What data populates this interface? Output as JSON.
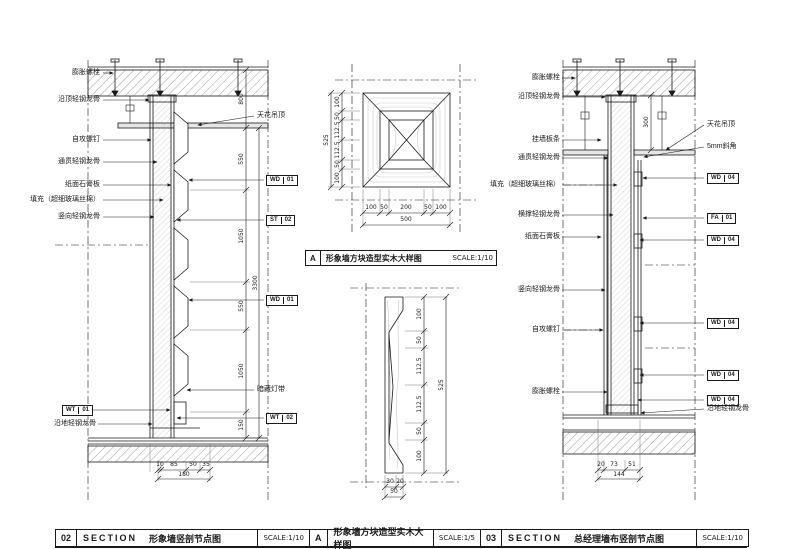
{
  "left_panel": {
    "labels_left": [
      "膨胀螺栓",
      "沿顶轻钢龙骨",
      "自攻螺钉",
      "通贯轻钢龙骨",
      "纸面石膏板",
      "填充（超细玻璃丝棉）",
      "竖向轻钢龙骨"
    ],
    "bottom_tag": {
      "c": "WT",
      "n": "01"
    },
    "bottom_label": "沿地轻钢龙骨",
    "label_ceiling": "天花吊顶",
    "label_light": "暗藏灯带",
    "tags_right": [
      {
        "c": "WD",
        "n": "01"
      },
      {
        "c": "ST",
        "n": "02"
      },
      {
        "c": "WD",
        "n": "01"
      },
      {
        "c": "WT",
        "n": "02"
      }
    ],
    "dim_top": "800",
    "dims_chain": [
      "550",
      "1050",
      "550",
      "1050",
      "150"
    ],
    "dim_total": "3300",
    "dims_bottom": [
      "10",
      "85",
      "50",
      "35"
    ],
    "dim_bottom_total": "180"
  },
  "middle_panel": {
    "label": {
      "key": "A",
      "title": "形象墙方块造型实木大样图",
      "scale": "SCALE:1/10"
    },
    "square": {
      "dims_left": [
        "100",
        "50",
        "112.5",
        "112.5",
        "50",
        "100"
      ],
      "dim_left_total": "525",
      "dims_bottom": [
        "100",
        "50",
        "200",
        "50",
        "100"
      ],
      "dim_bottom_total": "500"
    },
    "profile": {
      "dims_right": [
        "100",
        "50",
        "112.5",
        "112.5",
        "50",
        "100"
      ],
      "dim_right_total": "525",
      "dims_bottom": [
        "30",
        "20"
      ],
      "dim_bottom_total": "50"
    }
  },
  "right_panel": {
    "labels_left": [
      "膨胀螺栓",
      "沿顶轻钢龙骨",
      "挂墙板条",
      "通贯轻钢龙骨",
      "填充（超细玻璃丝棉）",
      "横撑轻钢龙骨",
      "纸面石膏板",
      "竖向轻钢龙骨",
      "自攻螺钉",
      "膨胀螺栓"
    ],
    "label_ceiling": "天花吊顶",
    "label_chamfer": "5mm斜角",
    "bottom_label": "沿地轻钢龙骨",
    "tags_right": [
      {
        "c": "WD",
        "n": "04"
      },
      {
        "c": "FA",
        "n": "01"
      },
      {
        "c": "WD",
        "n": "04"
      },
      {
        "c": "WD",
        "n": "04"
      },
      {
        "c": "WD",
        "n": "04"
      },
      {
        "c": "WD",
        "n": "04"
      }
    ],
    "dim_side": "300",
    "dims_bottom": [
      "20",
      "73",
      "51"
    ],
    "dim_bottom_total": "144"
  },
  "titlebar": {
    "blocks": [
      {
        "num": "02",
        "kind": "SECTION",
        "title": "形象墙竖剖节点图",
        "scale": "SCALE:1/10"
      },
      {
        "num": "A",
        "title": "形象墙方块造型实木大样图",
        "scale": "SCALE:1/5"
      },
      {
        "num": "03",
        "kind": "SECTION",
        "title": "总经理墙布竖剖节点图",
        "scale": "SCALE:1/10"
      }
    ]
  }
}
